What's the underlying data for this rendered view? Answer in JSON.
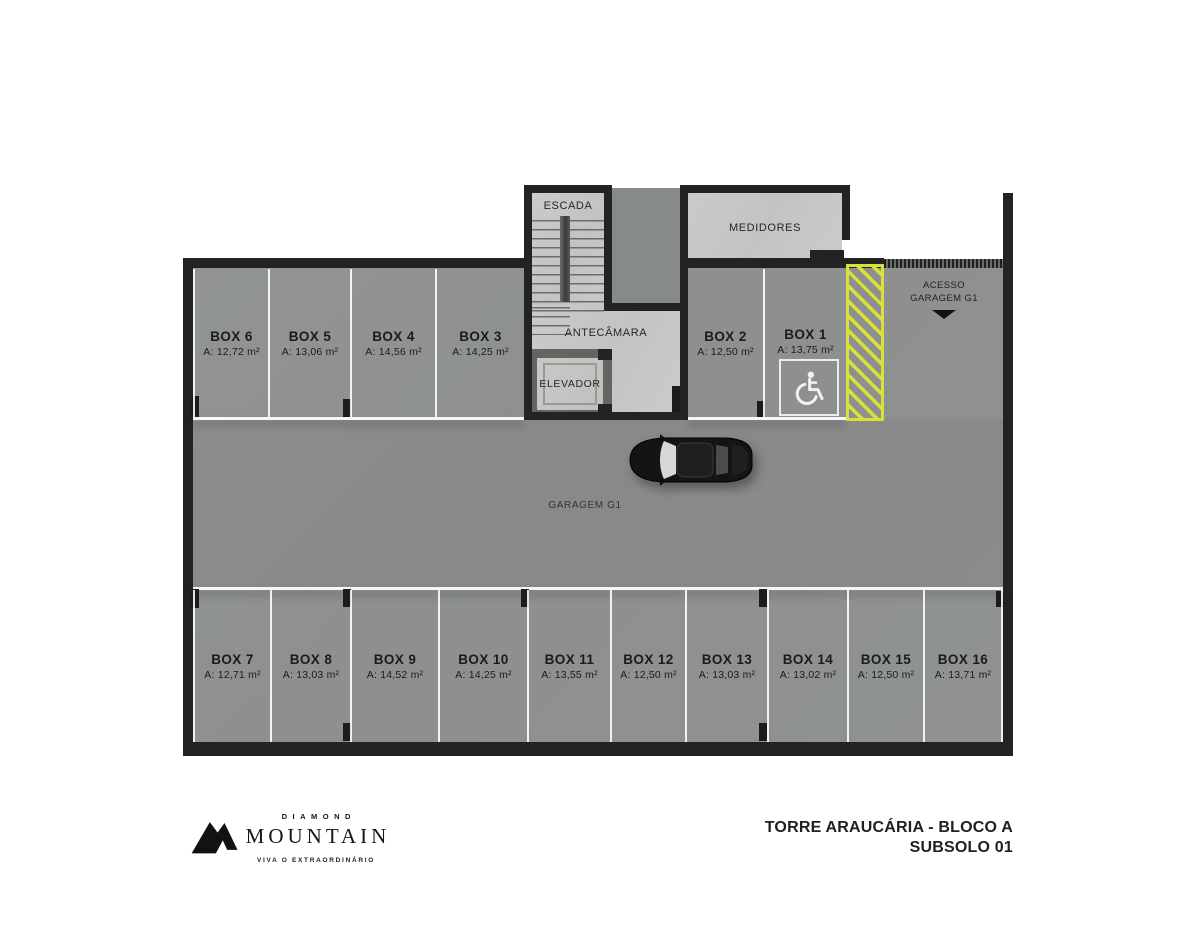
{
  "plan": {
    "rooms": {
      "escada": "ESCADA",
      "medidores": "MEDIDORES",
      "antecamara": "ANTECÂMARA",
      "elevador": "ELEVADOR",
      "garagem": "GARAGEM G1",
      "acesso_line1": "ACESSO",
      "acesso_line2": "GARAGEM G1"
    },
    "boxes": [
      {
        "label": "BOX 6",
        "area": "A: 12,72 m²"
      },
      {
        "label": "BOX 5",
        "area": "A: 13,06 m²"
      },
      {
        "label": "BOX 4",
        "area": "A: 14,56 m²"
      },
      {
        "label": "BOX 3",
        "area": "A: 14,25 m²"
      },
      {
        "label": "BOX 2",
        "area": "A: 12,50 m²"
      },
      {
        "label": "BOX 1",
        "area": "A: 13,75 m²"
      },
      {
        "label": "BOX 7",
        "area": "A: 12,71 m²"
      },
      {
        "label": "BOX 8",
        "area": "A: 13,03 m²"
      },
      {
        "label": "BOX 9",
        "area": "A: 14,52 m²"
      },
      {
        "label": "BOX 10",
        "area": "A: 14,25 m²"
      },
      {
        "label": "BOX 11",
        "area": "A: 13,55 m²"
      },
      {
        "label": "BOX 12",
        "area": "A: 12,50 m²"
      },
      {
        "label": "BOX 13",
        "area": "A: 13,03 m²"
      },
      {
        "label": "BOX 14",
        "area": "A: 13,02 m²"
      },
      {
        "label": "BOX 15",
        "area": "A: 12,50 m²"
      },
      {
        "label": "BOX 16",
        "area": "A: 13,71 m²"
      }
    ],
    "accessible_space": "BOX 1"
  },
  "footer": {
    "brand_top": "DIAMOND",
    "brand_main": "MOUNTAIN",
    "brand_tagline": "VIVA O EXTRAORDINÁRIO",
    "title_line1": "TORRE ARAUCÁRIA - BLOCO A",
    "title_line2": "SUBSOLO 01"
  },
  "colors": {
    "floor": "#8f9291",
    "light_room_floor": "#c8c7c5",
    "wall": "#232323",
    "hatch_yellow": "#d9e139",
    "background": "#ffffff"
  }
}
